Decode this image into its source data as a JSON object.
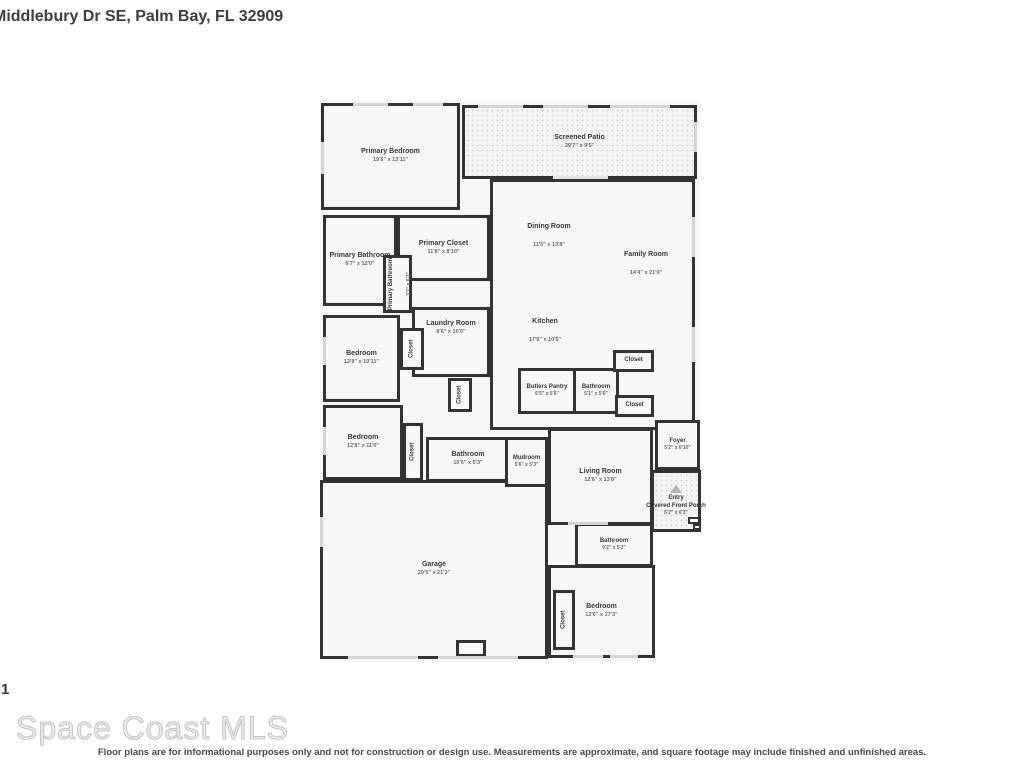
{
  "header": {
    "title": "Middlebury Dr SE, Palm Bay, FL 32909"
  },
  "floor_label": "1",
  "watermark": "Space Coast MLS",
  "disclaimer": "Floor plans are for informational purposes only and not for construction or design use. Measurements are approximate, and square footage may include finished and unfinished areas.",
  "colors": {
    "wall": "#333333",
    "floor": "#f7f7f7",
    "title_text": "#3d3d3d"
  },
  "rooms": {
    "closet_label": "Closet",
    "primary_bedroom": {
      "name": "Primary Bedroom",
      "dims": "19'6\" x 13'11\""
    },
    "screened_patio": {
      "name": "Screened Patio",
      "dims": "29'7\" x 9'5\""
    },
    "dining_room": {
      "name": "Dining Room",
      "dims": "11'5\" x 13'8\""
    },
    "family_room": {
      "name": "Family Room",
      "dims": "14'4\" x 21'9\""
    },
    "primary_bathroom": {
      "name": "Primary Bathroom",
      "dims": "6'7\" x 12'0\""
    },
    "primary_closet": {
      "name": "Primary Closet",
      "dims": "11'8\" x 8'10\""
    },
    "primary_water_closet": {
      "name": "Primary Bathroom",
      "dims": "3'7\" x 6'2\""
    },
    "laundry_room": {
      "name": "Laundry Room",
      "dims": "8'6\" x 10'5\""
    },
    "kitchen": {
      "name": "Kitchen",
      "dims": "17'9\" x 10'5\""
    },
    "bedroom_2": {
      "name": "Bedroom",
      "dims": "12'8\" x 10'11\""
    },
    "bedroom_3": {
      "name": "Bedroom",
      "dims": "12'8\" x 11'0\""
    },
    "butlers_pantry": {
      "name": "Butlers Pantry",
      "dims": "6'5\" x 5'6\""
    },
    "bathroom_2": {
      "name": "Bathroom",
      "dims": "5'1\" x 5'6\""
    },
    "bathroom_3": {
      "name": "Bathroom",
      "dims": "10'6\" x 5'3\""
    },
    "mudroom": {
      "name": "Mudroom",
      "dims": "5'6\" x 5'3\""
    },
    "living_room": {
      "name": "Living Room",
      "dims": "12'6\" x 13'8\""
    },
    "foyer": {
      "name": "Foyer",
      "dims": "5'2\" x 6'10\""
    },
    "entry_porch": {
      "line1": "Entry",
      "line2": "Covered Front Porch",
      "dims": "6'2\" x 6'3\""
    },
    "garage": {
      "name": "Garage",
      "dims": "29'5\" x 21'3\""
    },
    "bathroom_4": {
      "name": "Bathroom",
      "dims": "9'2\" x 5'2\""
    },
    "bedroom_4": {
      "name": "Bedroom",
      "dims": "12'6\" x 17'3\""
    }
  }
}
